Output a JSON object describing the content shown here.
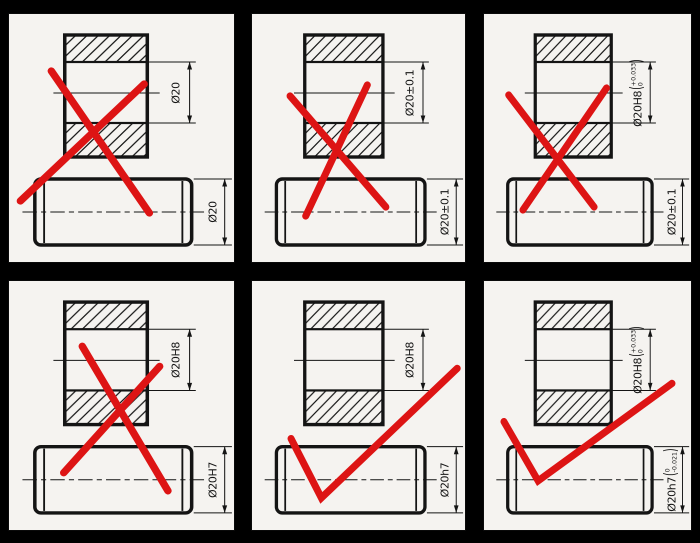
{
  "figure": {
    "description_type": "technical-drawing-grid",
    "background": "#000000",
    "panel_background": "#f5f3f0",
    "line_color": "#141414",
    "mark_color": "#dd1414",
    "rows": 2,
    "columns": 3
  },
  "notation": {
    "paren_open": "(",
    "paren_close": ")"
  },
  "panels": [
    {
      "name": "top-left",
      "verdict": "incorrect",
      "mark": {
        "type": "cross",
        "lines": [
          [
            42,
            58,
            137,
            200
          ],
          [
            12,
            188,
            132,
            71
          ]
        ]
      },
      "hole_dim": {
        "label": "Ø20"
      },
      "shaft_dim": {
        "label": "Ø20"
      }
    },
    {
      "name": "top-center",
      "verdict": "incorrect",
      "mark": {
        "type": "cross",
        "lines": [
          [
            40,
            83,
            138,
            194
          ],
          [
            56,
            203,
            119,
            72
          ]
        ]
      },
      "hole_dim": {
        "label": "Ø20±0.1"
      },
      "shaft_dim": {
        "label": "Ø20±0.1"
      }
    },
    {
      "name": "top-right",
      "verdict": "incorrect",
      "mark": {
        "type": "cross",
        "lines": [
          [
            27,
            82,
            117,
            194
          ],
          [
            42,
            197,
            130,
            75
          ]
        ]
      },
      "hole_dim": {
        "label": "Ø20H8",
        "tol_top": "+0.033",
        "tol_bottom": "0"
      },
      "shaft_dim": {
        "label": "Ø20±0.1"
      }
    },
    {
      "name": "bottom-left",
      "verdict": "incorrect",
      "mark": {
        "type": "cross",
        "lines": [
          [
            72,
            66,
            155,
            210
          ],
          [
            54,
            192,
            147,
            86
          ]
        ]
      },
      "hole_dim": {
        "label": "Ø20H8"
      },
      "shaft_dim": {
        "label": "Ø20H7"
      }
    },
    {
      "name": "bottom-center",
      "verdict": "correct",
      "mark": {
        "type": "check",
        "points": [
          41,
          158,
          72,
          217,
          211,
          88
        ]
      },
      "hole_dim": {
        "label": "Ø20H8"
      },
      "shaft_dim": {
        "label": "Ø20h7"
      }
    },
    {
      "name": "bottom-right",
      "verdict": "correct",
      "mark": {
        "type": "check",
        "points": [
          22,
          141,
          58,
          200,
          199,
          103
        ]
      },
      "hole_dim": {
        "label": "Ø20H8",
        "tol_top": "+0.033",
        "tol_bottom": "0"
      },
      "shaft_dim": {
        "label": "Ø20h7",
        "tol_top": "0",
        "tol_bottom": "-0.021"
      }
    }
  ]
}
